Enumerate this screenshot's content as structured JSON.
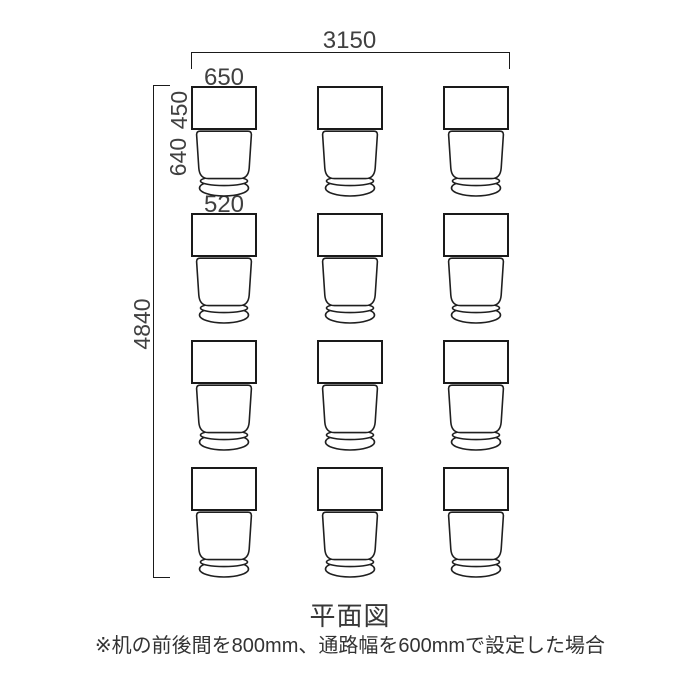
{
  "diagram": {
    "type": "floor-plan",
    "grid": {
      "rows": 4,
      "columns": 3,
      "unit": "desk-with-chair"
    },
    "dimensions": {
      "total_width": "3150",
      "desk_width": "650",
      "desk_depth": "450",
      "chair_depth": "640",
      "chair_width": "520",
      "total_height": "4840"
    }
  },
  "caption": {
    "title": "平面図",
    "note": "※机の前後間を800mm、通路幅を600mmで設定した場合"
  },
  "colors": {
    "line": "#1a1a1a",
    "text": "#404040",
    "background": "#ffffff"
  }
}
